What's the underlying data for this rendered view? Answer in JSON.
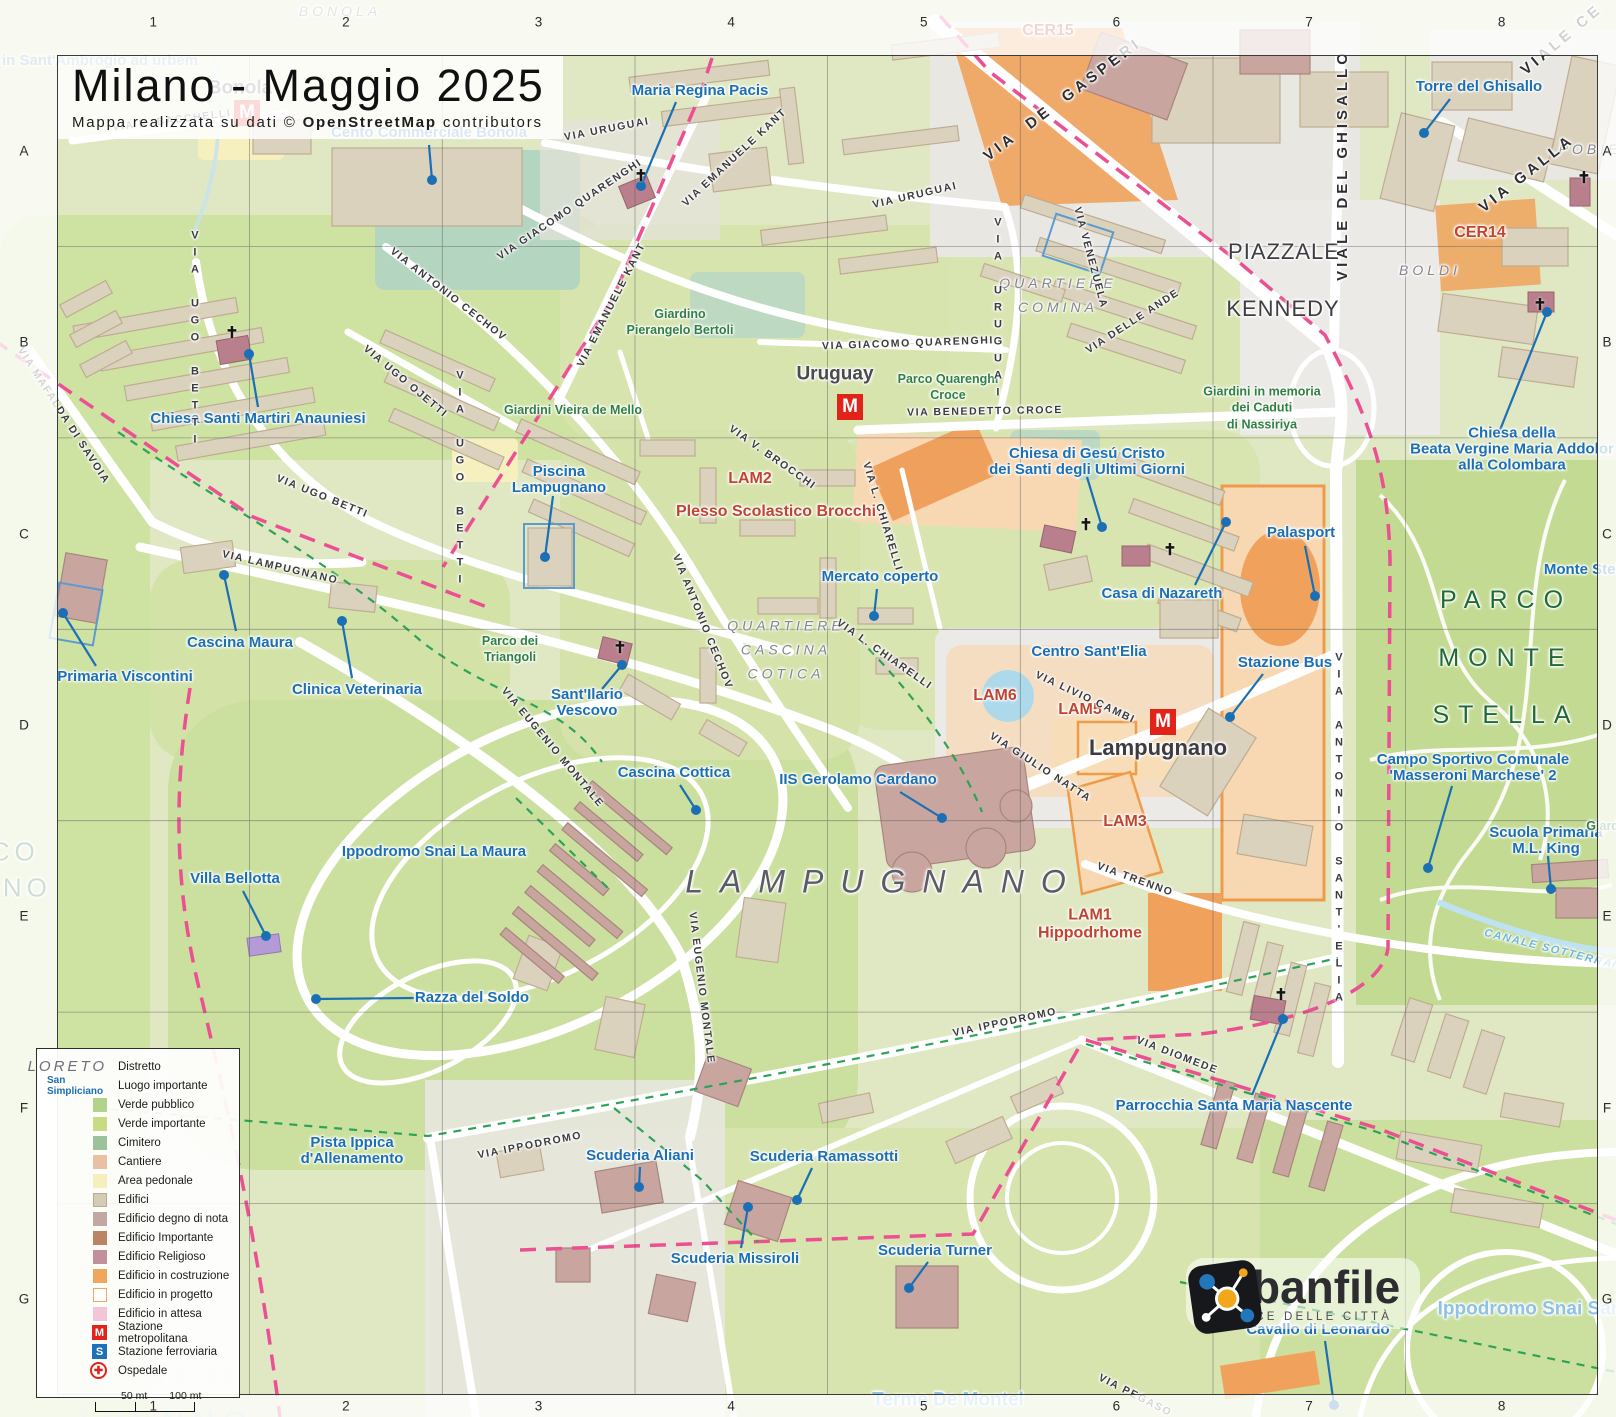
{
  "title": "Milano - Maggio 2025",
  "subtitle_prefix": "Mappa realizzata su dati  ©",
  "subtitle_bold": "OpenStreetMap",
  "subtitle_suffix": "contributors",
  "station_letters": {
    "metro": "M",
    "rail": "S"
  },
  "church_glyph": "✝",
  "colors": {
    "poi_blue": "#1b6fb4",
    "zone_red": "#c04530",
    "district_gray": "#84848d",
    "park_green": "#2f8043",
    "boundary_pink": "#ec4f92",
    "path_green": "#2ea358",
    "metro_red": "#e2231a",
    "rail_blue": "#1d71b8"
  },
  "grid": {
    "cols": [
      "1",
      "2",
      "3",
      "4",
      "5",
      "6",
      "7",
      "8"
    ],
    "rows": [
      "A",
      "B",
      "C",
      "D",
      "E",
      "F",
      "G"
    ]
  },
  "legend": {
    "district_sample": "LORETO",
    "district_label": "Distretto",
    "place_sample": "San Simpliciano",
    "place_label": "Luogo importante",
    "swatches": [
      {
        "label": "Verde pubblico",
        "color": "#b0d48a"
      },
      {
        "label": "Verde importante",
        "color": "#c9db82"
      },
      {
        "label": "Cimitero",
        "color": "#9cc29c"
      },
      {
        "label": "Cantiere",
        "color": "#e9c0a4"
      },
      {
        "label": "Area pedonale",
        "color": "#f5efbd"
      },
      {
        "label": "Edifici",
        "color": "#d5ccb6",
        "border": "#b9ab90"
      },
      {
        "label": "Edificio degno di nota",
        "color": "#c3a7a3"
      },
      {
        "label": "Edificio Importante",
        "color": "#bb8465"
      },
      {
        "label": "Edificio Religioso",
        "color": "#c28f9d"
      },
      {
        "label": "Edificio in costruzione",
        "color": "#f0a65f"
      },
      {
        "label": "Edificio in progetto",
        "color": "#ffffff",
        "border": "#f0a65f"
      },
      {
        "label": "Edificio in attesa",
        "color": "#f2c5d8"
      }
    ],
    "icons": [
      {
        "label": "Stazione metropolitana",
        "glyph": "M",
        "bg": "#e2231a",
        "shape": "square"
      },
      {
        "label": "Stazione ferroviaria",
        "glyph": "S",
        "bg": "#1d71b8",
        "shape": "square"
      },
      {
        "label": "Ospedale",
        "glyph": "✚",
        "bg": "#ffffff",
        "shape": "circle"
      }
    ],
    "scale_half": "50 mt",
    "scale_full": "100 mt"
  },
  "logo": {
    "name": "urbanfile",
    "tagline": "LA VOCE DELLE CITTÀ"
  },
  "markers": [
    {
      "type": "metro",
      "x": 247,
      "y": 113
    },
    {
      "type": "metro",
      "x": 850,
      "y": 407
    },
    {
      "type": "metro",
      "x": 1163,
      "y": 722
    },
    {
      "type": "cross",
      "x": 641,
      "y": 176
    },
    {
      "type": "cross",
      "x": 232,
      "y": 333
    },
    {
      "type": "cross",
      "x": 620,
      "y": 648
    },
    {
      "type": "cross",
      "x": 1086,
      "y": 525
    },
    {
      "type": "cross",
      "x": 1170,
      "y": 550
    },
    {
      "type": "cross",
      "x": 1281,
      "y": 995
    },
    {
      "type": "cross",
      "x": 1584,
      "y": 178
    },
    {
      "type": "cross",
      "x": 1540,
      "y": 305
    }
  ],
  "labels": [
    {
      "t": "Maria Regina Pacis",
      "x": 700,
      "y": 91,
      "d": [
        641,
        186
      ],
      "l": [
        676,
        102
      ]
    },
    {
      "t": "Cento Commerciale Bonola",
      "x": 429,
      "y": 133,
      "d": [
        432,
        180
      ],
      "l": [
        429,
        145
      ]
    },
    {
      "t": "Torre del Ghisallo",
      "x": 1479,
      "y": 87,
      "d": [
        1424,
        133
      ],
      "l": [
        1450,
        99
      ]
    },
    {
      "t": "Chiesa Santi Martiri Anauniesi",
      "x": 258,
      "y": 419,
      "d": [
        249,
        354
      ],
      "l": [
        258,
        407
      ]
    },
    {
      "t": "Chiesa della\nBeata Vergine Maria Addolor\nalla Colombara",
      "x": 1512,
      "y": 450,
      "d": [
        1547,
        312
      ],
      "l": [
        1500,
        430
      ]
    },
    {
      "t": "Piscina\nLampugnano",
      "x": 559,
      "y": 480,
      "d": [
        545,
        557
      ],
      "l": [
        553,
        496
      ]
    },
    {
      "t": "Cascina Maura",
      "x": 240,
      "y": 643,
      "d": [
        224,
        575
      ],
      "l": [
        236,
        631
      ]
    },
    {
      "t": "Primaria Viscontini",
      "x": 125,
      "y": 677,
      "d": [
        63,
        613
      ],
      "l": [
        96,
        666
      ]
    },
    {
      "t": "Clinica Veterinaria",
      "x": 357,
      "y": 690,
      "d": [
        342,
        621
      ],
      "l": [
        352,
        678
      ]
    },
    {
      "t": "Mercato coperto",
      "x": 880,
      "y": 577,
      "d": [
        874,
        616
      ],
      "l": [
        877,
        589
      ]
    },
    {
      "t": "Sant'Ilario\nVescovo",
      "x": 587,
      "y": 703,
      "d": [
        622,
        665
      ],
      "l": [
        602,
        689
      ]
    },
    {
      "t": "Cascina Cottica",
      "x": 674,
      "y": 773,
      "d": [
        696,
        810
      ],
      "l": [
        680,
        785
      ]
    },
    {
      "t": "IIS Gerolamo Cardano",
      "x": 858,
      "y": 780,
      "d": [
        942,
        818
      ],
      "l": [
        900,
        792
      ]
    },
    {
      "t": "Chiesa di Gesú Cristo\ndei Santi degli Ultimi Giorni",
      "x": 1087,
      "y": 462,
      "d": [
        1102,
        527
      ],
      "l": [
        1087,
        477
      ]
    },
    {
      "t": "Casa di Nazareth",
      "x": 1162,
      "y": 594,
      "d": [
        1226,
        522
      ],
      "l": [
        1195,
        585
      ]
    },
    {
      "t": "Palasport",
      "x": 1301,
      "y": 533,
      "d": [
        1315,
        596
      ],
      "l": [
        1305,
        546
      ]
    },
    {
      "t": "Stazione Bus",
      "x": 1285,
      "y": 663,
      "d": [
        1230,
        717
      ],
      "l": [
        1263,
        674
      ]
    },
    {
      "t": "Centro Sant'Elia",
      "x": 1089,
      "y": 652
    },
    {
      "t": "Campo Sportivo Comunale\n'Masseroni Marchese' 2",
      "x": 1473,
      "y": 768,
      "d": [
        1428,
        868
      ],
      "l": [
        1452,
        786
      ]
    },
    {
      "t": "Scuola Primaria\nM.L. King",
      "x": 1546,
      "y": 841,
      "d": [
        1551,
        889
      ],
      "l": [
        1548,
        856
      ]
    },
    {
      "t": "Villa Bellotta",
      "x": 235,
      "y": 879,
      "d": [
        266,
        936
      ],
      "l": [
        243,
        891
      ]
    },
    {
      "t": "Razza del Soldo",
      "x": 472,
      "y": 998,
      "d": [
        316,
        999
      ],
      "l": [
        414,
        998
      ]
    },
    {
      "t": "Ippodromo Snai La Maura",
      "x": 434,
      "y": 852
    },
    {
      "t": "Pista Ippica\nd'Allenamento",
      "x": 352,
      "y": 1151
    },
    {
      "t": "Scuderia Aliani",
      "x": 640,
      "y": 1156,
      "d": [
        639,
        1187
      ],
      "l": [
        640,
        1167
      ]
    },
    {
      "t": "Scuderia Ramassotti",
      "x": 824,
      "y": 1157,
      "d": [
        797,
        1200
      ],
      "l": [
        812,
        1168
      ]
    },
    {
      "t": "Scuderia Missiroli",
      "x": 735,
      "y": 1259,
      "d": [
        748,
        1207
      ],
      "l": [
        741,
        1248
      ]
    },
    {
      "t": "Scuderia Turner",
      "x": 935,
      "y": 1251,
      "d": [
        909,
        1288
      ],
      "l": [
        928,
        1262
      ]
    },
    {
      "t": "Parrocchia Santa Maria Nascente",
      "x": 1234,
      "y": 1106,
      "d": [
        1283,
        1019
      ],
      "l": [
        1252,
        1095
      ]
    },
    {
      "t": "Cavallo di Leonardo",
      "x": 1318,
      "y": 1330,
      "d": [
        1334,
        1405
      ],
      "l": [
        1325,
        1341
      ]
    },
    {
      "t": "Monte Stella",
      "x": 1588,
      "y": 570
    },
    {
      "t": "in Sant'Ambrogio ad urbem",
      "x": 100,
      "y": 61,
      "c": "poi faded"
    },
    {
      "t": "Giardino",
      "x": 1612,
      "y": 826,
      "c": "park"
    },
    {
      "t": "Giardino\nPierangelo Bertoli",
      "x": 680,
      "y": 322,
      "c": "park"
    },
    {
      "t": "Giardini Vieira de Mello",
      "x": 573,
      "y": 410,
      "c": "park"
    },
    {
      "t": "Parco Quarenghi\nCroce",
      "x": 948,
      "y": 387,
      "c": "park"
    },
    {
      "t": "Giardini in memoria\ndei Caduti\ndi Nassiriya",
      "x": 1262,
      "y": 408,
      "c": "park"
    },
    {
      "t": "Parco dei\nTriangoli",
      "x": 510,
      "y": 649,
      "c": "park"
    },
    {
      "t": "PARCO\nMONTE\nSTELLA",
      "x": 1506,
      "y": 658,
      "c": "park-xl"
    },
    {
      "t": "PARCO\nTRENNO",
      "x": 165,
      "y": 1400,
      "c": "park-ghost"
    },
    {
      "t": "PARCO\nTRENNO",
      "x": -18,
      "y": 870,
      "c": "park-lg"
    },
    {
      "t": "BONOLA",
      "x": 340,
      "y": 12,
      "c": "district"
    },
    {
      "t": "QUARTIERE\nCOMINA",
      "x": 1058,
      "y": 296,
      "c": "district"
    },
    {
      "t": "QUARTIERE\nCASCINA\nCOTICA",
      "x": 786,
      "y": 650,
      "c": "district"
    },
    {
      "t": "LAMPUGNANO",
      "x": 884,
      "y": 882,
      "c": "district-xl"
    },
    {
      "t": "PIAZZALE",
      "x": 1284,
      "y": 252,
      "c": "piazza"
    },
    {
      "t": "KENNEDY",
      "x": 1283,
      "y": 309,
      "c": "piazza"
    },
    {
      "t": "BOLDI",
      "x": 1430,
      "y": 271,
      "c": "district"
    },
    {
      "t": "POBIE",
      "x": 1590,
      "y": 150,
      "c": "district"
    },
    {
      "t": "Bonola",
      "x": 240,
      "y": 89,
      "c": "metro-name"
    },
    {
      "t": "Uruguay",
      "x": 835,
      "y": 375,
      "c": "metro-name"
    },
    {
      "t": "Lampugnano",
      "x": 1158,
      "y": 748,
      "c": "metro-name-lg"
    },
    {
      "t": "CER15",
      "x": 1048,
      "y": 31,
      "c": "red-lg"
    },
    {
      "t": "CER14",
      "x": 1480,
      "y": 233,
      "c": "red-lg"
    },
    {
      "t": "LAM2",
      "x": 750,
      "y": 479,
      "c": "red-lg"
    },
    {
      "t": "Plesso Scolastico Brocchi",
      "x": 776,
      "y": 512,
      "c": "red-lg"
    },
    {
      "t": "LAM6",
      "x": 995,
      "y": 696,
      "c": "red-lg"
    },
    {
      "t": "LAM5",
      "x": 1080,
      "y": 710,
      "c": "red-lg"
    },
    {
      "t": "LAM3",
      "x": 1125,
      "y": 822,
      "c": "red-lg"
    },
    {
      "t": "LAM1\nHippodrhome",
      "x": 1090,
      "y": 925,
      "c": "red-lg"
    },
    {
      "t": "VIA R. BACCHELLI",
      "x": 172,
      "y": 121,
      "c": "street",
      "r": -7
    },
    {
      "t": "VIA URUGUAI",
      "x": 607,
      "y": 130,
      "c": "street",
      "r": -11
    },
    {
      "t": "VIA URUGUAI",
      "x": 915,
      "y": 196,
      "c": "street",
      "r": -13
    },
    {
      "t": "VIA URUGUAI",
      "x": 997,
      "y": 310,
      "c": "street-v"
    },
    {
      "t": "VIA EMANUELE KANT",
      "x": 735,
      "y": 158,
      "c": "street",
      "r": -43
    },
    {
      "t": "VIA EMANUELE KANT",
      "x": 612,
      "y": 305,
      "c": "street",
      "r": -63
    },
    {
      "t": "VIA GIACOMO QUARENGHI",
      "x": 570,
      "y": 210,
      "c": "street",
      "r": -34
    },
    {
      "t": "VIA GIACOMO QUARENGHI",
      "x": 908,
      "y": 344,
      "c": "street",
      "r": -2
    },
    {
      "t": "VIA BENEDETTO CROCE",
      "x": 985,
      "y": 412,
      "c": "street",
      "r": -1
    },
    {
      "t": "VIA VENEZUELA",
      "x": 1090,
      "y": 258,
      "c": "street",
      "r": 75
    },
    {
      "t": "VIA DELLE ANDE",
      "x": 1133,
      "y": 322,
      "c": "street",
      "r": -33
    },
    {
      "t": "VIA  DE  GASPERI",
      "x": 1063,
      "y": 100,
      "c": "street-lg",
      "r": -37
    },
    {
      "t": "VIALE DEL GHISALLO",
      "x": 1343,
      "y": 165,
      "c": "street-lg",
      "r": -90
    },
    {
      "t": "VIALE CE",
      "x": 1562,
      "y": 40,
      "c": "street-lg",
      "r": -40
    },
    {
      "t": "VIA GALLA",
      "x": 1527,
      "y": 174,
      "c": "street-lg",
      "r": -38
    },
    {
      "t": "VIA UGO BETTI",
      "x": 194,
      "y": 340,
      "c": "street-v"
    },
    {
      "t": "VIA UGO OJETTI",
      "x": 405,
      "y": 382,
      "c": "street",
      "r": 40
    },
    {
      "t": "VIA UGO BETTI",
      "x": 322,
      "y": 497,
      "c": "street",
      "r": 22
    },
    {
      "t": "VIA UGO BETTI",
      "x": 459,
      "y": 480,
      "c": "street-v"
    },
    {
      "t": "VIA MAFALDA DI SAVOIA",
      "x": 63,
      "y": 416,
      "c": "street",
      "r": 57
    },
    {
      "t": "VIA LAMPUGNANO",
      "x": 280,
      "y": 568,
      "c": "street",
      "r": 13
    },
    {
      "t": "VIA ANTONIO CECHOV",
      "x": 448,
      "y": 295,
      "c": "street",
      "r": 38
    },
    {
      "t": "VIA ANTONIO CECHOV",
      "x": 702,
      "y": 622,
      "c": "street",
      "r": 68
    },
    {
      "t": "VIA V. BROCCHI",
      "x": 772,
      "y": 458,
      "c": "street",
      "r": 35
    },
    {
      "t": "VIA L. CHIARELLI",
      "x": 882,
      "y": 517,
      "c": "street",
      "r": 73
    },
    {
      "t": "VIA L. CHIARELLI",
      "x": 884,
      "y": 655,
      "c": "street",
      "r": 35
    },
    {
      "t": "VIA EUGENIO MONTALE",
      "x": 552,
      "y": 748,
      "c": "street",
      "r": 50
    },
    {
      "t": "VIA EUGENIO MONTALE",
      "x": 701,
      "y": 988,
      "c": "street",
      "r": 83
    },
    {
      "t": "VIA LIVIO CAMBI",
      "x": 1085,
      "y": 698,
      "c": "street",
      "r": 25
    },
    {
      "t": "VIA GIULIO NATTA",
      "x": 1040,
      "y": 768,
      "c": "street",
      "r": 33
    },
    {
      "t": "VIA ANTONIO SANT'ELIA",
      "x": 1338,
      "y": 830,
      "c": "street-v"
    },
    {
      "t": "VIA TRENNO",
      "x": 1135,
      "y": 880,
      "c": "street",
      "r": 20
    },
    {
      "t": "VIA IPPODROMO",
      "x": 530,
      "y": 1146,
      "c": "street",
      "r": -11
    },
    {
      "t": "VIA IPPODROMO",
      "x": 1005,
      "y": 1023,
      "c": "street",
      "r": -12
    },
    {
      "t": "VIA DIOMEDE",
      "x": 1177,
      "y": 1056,
      "c": "street",
      "r": 21
    },
    {
      "t": "VIA PEGASO",
      "x": 1135,
      "y": 1396,
      "c": "street",
      "r": 27
    },
    {
      "t": "CANALE SOTTERRANEO",
      "x": 1562,
      "y": 953,
      "c": "water",
      "r": 14
    },
    {
      "t": "Terme De Montel",
      "x": 948,
      "y": 1401,
      "c": "lightblue-lg"
    },
    {
      "t": "Ippodromo Snai San",
      "x": 1530,
      "y": 1310,
      "c": "lightblue-lg"
    }
  ]
}
